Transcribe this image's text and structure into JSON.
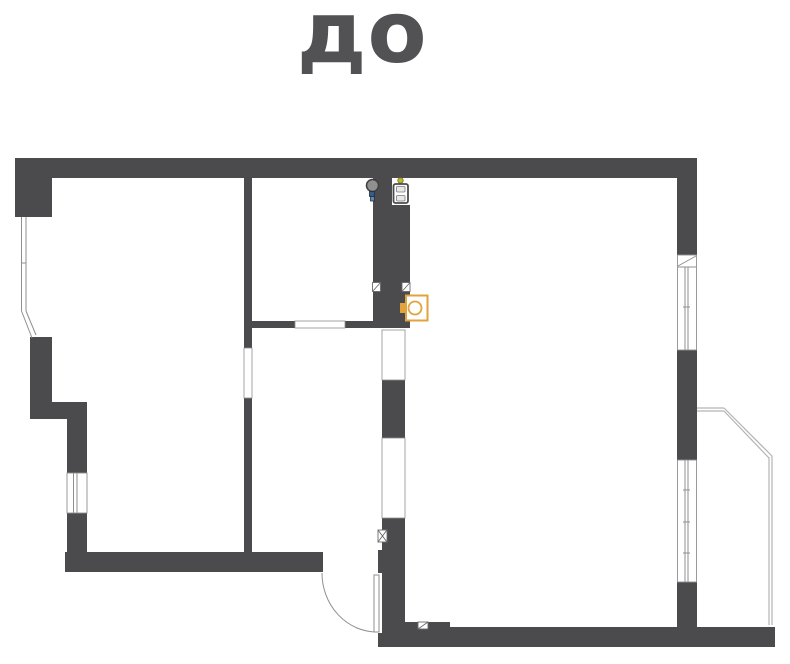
{
  "title": "до",
  "colors": {
    "wall": "#4b4b4d",
    "white": "#ffffff",
    "line": "#8f8f8f",
    "light": "#b3b3b3",
    "dark": "#6a6a6a",
    "orange": "#e2a23c",
    "gray": "#909090",
    "grayStroke": "#3f3f41",
    "blue1": "#3a5a80",
    "blue2": "#6286ab",
    "blueStroke": "#1d2f45",
    "yellow": "#b9bd2e",
    "yellowStroke": "#6e7119",
    "panelFill": "#e8e8e8",
    "panelStroke": "#7a7a7a",
    "title": "#525255",
    "none": "none"
  },
  "plan": {
    "canvas": {
      "w": 790,
      "h": 664
    },
    "shapes": [
      {
        "t": "rect",
        "name": "top-wall",
        "x": 15,
        "y": 158,
        "w": 682,
        "h": 20,
        "f": "wall"
      },
      {
        "t": "rect",
        "name": "top-left-block",
        "x": 15,
        "y": 158,
        "w": 37,
        "h": 59,
        "f": "wall"
      },
      {
        "t": "rect",
        "name": "left-block",
        "x": 30,
        "y": 337,
        "w": 22,
        "h": 82,
        "f": "wall"
      },
      {
        "t": "rect",
        "name": "left-step-arm",
        "x": 30,
        "y": 402,
        "w": 57,
        "h": 17,
        "f": "wall"
      },
      {
        "t": "rect",
        "name": "left-wall-upper",
        "x": 67,
        "y": 419,
        "w": 20,
        "h": 55,
        "f": "wall"
      },
      {
        "t": "rect",
        "name": "left-wall-lower",
        "x": 67,
        "y": 513,
        "w": 20,
        "h": 45,
        "f": "wall"
      },
      {
        "t": "rect",
        "name": "bottom-left-wall",
        "x": 65,
        "y": 552,
        "w": 258,
        "h": 20,
        "f": "wall"
      },
      {
        "t": "rect",
        "name": "interior-wall-upper",
        "x": 244,
        "y": 178,
        "w": 8,
        "h": 170,
        "f": "wall"
      },
      {
        "t": "rect",
        "name": "interior-wall-lower",
        "x": 244,
        "y": 398,
        "w": 8,
        "h": 154,
        "f": "wall"
      },
      {
        "t": "rect",
        "name": "mid-wall-left",
        "x": 252,
        "y": 321,
        "w": 43,
        "h": 7,
        "f": "wall"
      },
      {
        "t": "rect",
        "name": "mid-wall-right",
        "x": 345,
        "y": 321,
        "w": 28,
        "h": 7,
        "f": "wall"
      },
      {
        "t": "rect",
        "name": "duct-column-top-left",
        "x": 373,
        "y": 178,
        "w": 19,
        "h": 27,
        "f": "wall"
      },
      {
        "t": "rect",
        "name": "duct-column",
        "x": 373,
        "y": 205,
        "w": 37,
        "h": 123,
        "f": "wall"
      },
      {
        "t": "rect",
        "name": "hall-wall-upper",
        "x": 382,
        "y": 380,
        "w": 23,
        "h": 58,
        "f": "wall"
      },
      {
        "t": "rect",
        "name": "hall-wall-lower",
        "x": 382,
        "y": 518,
        "w": 23,
        "h": 129,
        "f": "wall"
      },
      {
        "t": "rect",
        "name": "door-jamb",
        "x": 378,
        "y": 550,
        "w": 4,
        "h": 23,
        "f": "wall"
      },
      {
        "t": "rect",
        "name": "bottom-stub",
        "x": 378,
        "y": 633,
        "w": 4,
        "h": 14,
        "f": "wall"
      },
      {
        "t": "rect",
        "name": "bottom-arm",
        "x": 405,
        "y": 622,
        "w": 45,
        "h": 25,
        "f": "wall"
      },
      {
        "t": "rect",
        "name": "bottom-wall",
        "x": 445,
        "y": 627,
        "w": 330,
        "h": 20,
        "f": "wall"
      },
      {
        "t": "rect",
        "name": "right-wall-top",
        "x": 677,
        "y": 158,
        "w": 20,
        "h": 97,
        "f": "wall"
      },
      {
        "t": "rect",
        "name": "right-wall-mid",
        "x": 677,
        "y": 350,
        "w": 20,
        "h": 110,
        "f": "wall"
      },
      {
        "t": "rect",
        "name": "right-wall-bottom",
        "x": 677,
        "y": 582,
        "w": 20,
        "h": 45,
        "f": "wall"
      },
      {
        "t": "rect",
        "name": "window-left",
        "x": 67,
        "y": 473,
        "w": 20,
        "h": 40,
        "f": "white",
        "s": "line",
        "sw": 0.9
      },
      {
        "t": "rect",
        "name": "window-right-upper",
        "x": 677.5,
        "y": 255,
        "w": 19,
        "h": 95,
        "f": "white",
        "s": "line",
        "sw": 0.9
      },
      {
        "t": "rect",
        "name": "window-right-lower",
        "x": 677.5,
        "y": 460,
        "w": 19,
        "h": 122,
        "f": "white",
        "s": "line",
        "sw": 0.9
      },
      {
        "t": "rect",
        "name": "opening-interior-wall",
        "x": 244,
        "y": 348,
        "w": 8,
        "h": 50,
        "f": "white",
        "s": "line",
        "sw": 0.8
      },
      {
        "t": "rect",
        "name": "opening-mid-wall",
        "x": 295,
        "y": 321,
        "w": 50,
        "h": 7,
        "f": "white",
        "s": "line",
        "sw": 0.8
      },
      {
        "t": "rect",
        "name": "opening-hall-upper",
        "x": 382,
        "y": 330,
        "w": 23,
        "h": 50,
        "f": "white",
        "s": "line",
        "sw": 0.8
      },
      {
        "t": "rect",
        "name": "opening-bath-door",
        "x": 382,
        "y": 438,
        "w": 23,
        "h": 80,
        "f": "white",
        "s": "line",
        "sw": 0.8
      },
      {
        "t": "line",
        "name": "bay-window-line",
        "x1": 21.5,
        "y1": 217,
        "x2": 21.5,
        "y2": 311,
        "s": "line",
        "sw": 1
      },
      {
        "t": "line",
        "name": "bay-window-line",
        "x1": 26,
        "y1": 217,
        "x2": 26,
        "y2": 311,
        "s": "line",
        "sw": 1
      },
      {
        "t": "line",
        "name": "bay-window-tick",
        "x1": 21.5,
        "y1": 263,
        "x2": 26,
        "y2": 263,
        "s": "line",
        "sw": 1
      },
      {
        "t": "line",
        "name": "bay-window-line",
        "x1": 21.5,
        "y1": 311,
        "x2": 32,
        "y2": 338,
        "s": "line",
        "sw": 1
      },
      {
        "t": "line",
        "name": "bay-window-line",
        "x1": 26,
        "y1": 311,
        "x2": 36,
        "y2": 335,
        "s": "line",
        "sw": 1
      },
      {
        "t": "line",
        "name": "window-left-glass",
        "x1": 73.5,
        "y1": 473,
        "x2": 73.5,
        "y2": 513,
        "s": "line",
        "sw": 1
      },
      {
        "t": "line",
        "name": "window-left-glass",
        "x1": 77,
        "y1": 473,
        "x2": 77,
        "y2": 513,
        "s": "line",
        "sw": 1
      },
      {
        "t": "line",
        "name": "window-sill-diagonal",
        "x1": 678,
        "y1": 266,
        "x2": 696,
        "y2": 256,
        "s": "line",
        "sw": 1
      },
      {
        "t": "line",
        "name": "window-sill-base",
        "x1": 678,
        "y1": 267,
        "x2": 696,
        "y2": 267,
        "s": "line",
        "sw": 1
      },
      {
        "t": "line",
        "name": "window-right-upper-glass",
        "x1": 685,
        "y1": 267,
        "x2": 685,
        "y2": 350,
        "s": "line",
        "sw": 1
      },
      {
        "t": "line",
        "name": "window-right-upper-glass",
        "x1": 688,
        "y1": 267,
        "x2": 688,
        "y2": 350,
        "s": "line",
        "sw": 1
      },
      {
        "t": "line",
        "name": "window-tick",
        "x1": 683,
        "y1": 307,
        "x2": 690,
        "y2": 307,
        "s": "line",
        "sw": 1
      },
      {
        "t": "line",
        "name": "window-right-lower-glass",
        "x1": 685,
        "y1": 460,
        "x2": 685,
        "y2": 582,
        "s": "line",
        "sw": 1
      },
      {
        "t": "line",
        "name": "window-right-lower-glass",
        "x1": 688,
        "y1": 460,
        "x2": 688,
        "y2": 582,
        "s": "line",
        "sw": 1
      },
      {
        "t": "line",
        "name": "window-tick",
        "x1": 683,
        "y1": 490,
        "x2": 690,
        "y2": 490,
        "s": "line",
        "sw": 1
      },
      {
        "t": "line",
        "name": "window-tick",
        "x1": 683,
        "y1": 522,
        "x2": 690,
        "y2": 522,
        "s": "line",
        "sw": 1
      },
      {
        "t": "line",
        "name": "window-tick",
        "x1": 683,
        "y1": 553,
        "x2": 690,
        "y2": 553,
        "s": "line",
        "sw": 1
      },
      {
        "t": "line",
        "name": "balcony-outline",
        "x1": 697,
        "y1": 408,
        "x2": 724,
        "y2": 408,
        "s": "light",
        "sw": 1.2
      },
      {
        "t": "line",
        "name": "balcony-outline",
        "x1": 697,
        "y1": 411,
        "x2": 724,
        "y2": 411,
        "s": "light",
        "sw": 1.2
      },
      {
        "t": "line",
        "name": "balcony-outline",
        "x1": 724,
        "y1": 408,
        "x2": 772,
        "y2": 456,
        "s": "light",
        "sw": 1.2
      },
      {
        "t": "line",
        "name": "balcony-outline",
        "x1": 724,
        "y1": 411,
        "x2": 769,
        "y2": 458,
        "s": "light",
        "sw": 1.2
      },
      {
        "t": "line",
        "name": "balcony-outline",
        "x1": 769,
        "y1": 457,
        "x2": 769,
        "y2": 625,
        "s": "light",
        "sw": 1.2
      },
      {
        "t": "line",
        "name": "balcony-outline",
        "x1": 772,
        "y1": 456,
        "x2": 772,
        "y2": 625,
        "s": "light",
        "sw": 1.2
      },
      {
        "t": "path",
        "name": "door-arc",
        "d": "M322,573 A55,59 0 0 0 377,632",
        "f": "none",
        "s": "line",
        "sw": 1
      },
      {
        "t": "rect",
        "name": "door-leaf",
        "x": 374,
        "y": 575,
        "w": 5,
        "h": 57,
        "f": "white",
        "s": "line",
        "sw": 1
      },
      {
        "t": "rect",
        "name": "vent-marker-left",
        "x": 372.5,
        "y": 282.5,
        "w": 8,
        "h": 9,
        "f": "white",
        "s": "dark",
        "sw": 0.9
      },
      {
        "t": "line",
        "name": "vent-marker-left-diagonal",
        "x1": 372.5,
        "y1": 291.5,
        "x2": 380.5,
        "y2": 282.5,
        "s": "dark",
        "sw": 0.9
      },
      {
        "t": "rect",
        "name": "vent-marker-right",
        "x": 402,
        "y": 282.5,
        "w": 8,
        "h": 9,
        "f": "white",
        "s": "dark",
        "sw": 0.9
      },
      {
        "t": "line",
        "name": "vent-marker-right-diagonal",
        "x1": 402,
        "y1": 291.5,
        "x2": 410,
        "y2": 282.5,
        "s": "dark",
        "sw": 0.9
      },
      {
        "t": "rect",
        "name": "hatch-marker",
        "x": 378,
        "y": 530,
        "w": 9,
        "h": 12,
        "f": "white",
        "s": "dark",
        "sw": 0.9
      },
      {
        "t": "line",
        "name": "hatch-marker-diagonal",
        "x1": 378,
        "y1": 530,
        "x2": 387,
        "y2": 542,
        "s": "dark",
        "sw": 0.9
      },
      {
        "t": "line",
        "name": "hatch-marker-diagonal",
        "x1": 387,
        "y1": 530,
        "x2": 378,
        "y2": 542,
        "s": "dark",
        "sw": 0.9
      },
      {
        "t": "rect",
        "name": "triangle-marker",
        "x": 418,
        "y": 622,
        "w": 10,
        "h": 7,
        "f": "white",
        "s": "dark",
        "sw": 0.9
      },
      {
        "t": "line",
        "name": "triangle-marker-diagonal",
        "x1": 418,
        "y1": 629,
        "x2": 428,
        "y2": 622,
        "s": "dark",
        "sw": 0.9
      },
      {
        "t": "circle",
        "name": "plumbing-riser-icon",
        "cx": 372.5,
        "cy": 185.5,
        "r": 6,
        "f": "gray",
        "s": "grayStroke",
        "sw": 1.5
      },
      {
        "t": "rect",
        "name": "plumbing-valve-icon",
        "x": 369.5,
        "y": 191.5,
        "w": 5,
        "h": 5,
        "f": "blue1",
        "s": "blueStroke",
        "sw": 0.8
      },
      {
        "t": "rect",
        "name": "plumbing-valve-icon",
        "x": 370.5,
        "y": 196.5,
        "w": 4,
        "h": 4.5,
        "f": "blue2",
        "s": "blueStroke",
        "sw": 0.8
      },
      {
        "t": "circle",
        "name": "indicator-dot-icon",
        "cx": 400.5,
        "cy": 180.5,
        "r": 2.7,
        "f": "yellow",
        "s": "yellowStroke",
        "sw": 0.8
      },
      {
        "t": "rect",
        "name": "electrical-panel-icon",
        "x": 393.5,
        "y": 184,
        "w": 14.5,
        "h": 19,
        "rx": 2,
        "f": "white",
        "s": "wall",
        "sw": 1.8
      },
      {
        "t": "rect",
        "name": "electrical-panel-module",
        "x": 396.5,
        "y": 186.5,
        "w": 8.5,
        "h": 5.5,
        "rx": 1,
        "f": "panelFill",
        "s": "panelStroke",
        "sw": 0.8
      },
      {
        "t": "rect",
        "name": "electrical-panel-module",
        "x": 396.5,
        "y": 195.5,
        "w": 8.5,
        "h": 5.5,
        "rx": 1,
        "f": "panelFill",
        "s": "panelStroke",
        "sw": 0.8
      },
      {
        "t": "rect",
        "name": "toilet-tank-icon",
        "x": 400,
        "y": 303,
        "w": 6,
        "h": 10,
        "f": "orange"
      },
      {
        "t": "rect",
        "name": "toilet-bowl-icon",
        "x": 406,
        "y": 295.5,
        "w": 21.5,
        "h": 25,
        "f": "white",
        "s": "orange",
        "sw": 2
      },
      {
        "t": "circle",
        "name": "toilet-seat-icon",
        "cx": 415,
        "cy": 308,
        "r": 6.5,
        "f": "none",
        "s": "orange",
        "sw": 1.8
      }
    ]
  }
}
